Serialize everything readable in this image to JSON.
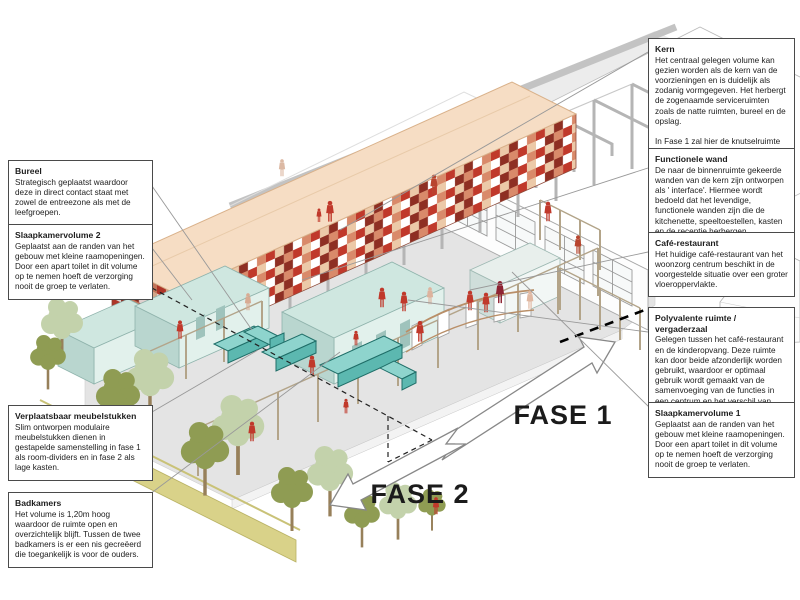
{
  "figure_labels": {
    "fase1": "FASE 1",
    "fase2": "FASE 2"
  },
  "annotations": {
    "right": [
      {
        "title": "Kern",
        "body": "Het centraal gelegen volume kan gezien worden als de kern van de voorzieningen en is duidelijk als zodanig vormgegeven. Het herbergt de zogenaamde serviceruimten zoals de natte ruimten, bureel en de opslag.\n\nIn Fase 1 zal hier de knutselruimte in worden ondergebracht die in Fase 2 wordt omgevormd tot een kantoortje."
      },
      {
        "title": "Functionele wand",
        "body": "De naar de binnenruimte gekeerde wanden van de kern zijn ontworpen als ' interface'. Hiermee wordt bedoeld dat het levendige, functionele wanden zijn die de kitchenette, speeltoestellen, kasten en de receptie herbergen."
      },
      {
        "title": "Café-restaurant",
        "body": "Het huidige café-restaurant van het woonzorg centrum beschikt in de voorgestelde situatie over een groter vloeroppervlakte."
      },
      {
        "title": "Polyvalente ruimte / vergaderzaal",
        "body": "Gelegen tussen het café-restaurant en de kinderopvang. Deze ruimte kan door beide afzonderlijk worden gebruikt, waardoor er optimaal gebruik wordt gemaakt van de samenvoeging van de functies in een centrum en het verschil van ieders ritme."
      },
      {
        "title": "Slaapkamervolume 1",
        "body": "Geplaatst aan de randen van het gebouw met kleine raamopeningen. Door een apart toilet in dit volume op te nemen hoeft de verzorging nooit de groep te verlaten."
      }
    ],
    "left": [
      {
        "title": "Bureel",
        "body": "Strategisch geplaatst waardoor deze in direct contact staat met zowel de entreezone als met de leefgroepen."
      },
      {
        "title": "Slaapkamervolume 2",
        "body": "Geplaatst aan de randen van het gebouw met kleine raamopeningen. Door een apart toilet in dit volume op te nemen hoeft de verzorging nooit de groep te verlaten."
      },
      {
        "title": "Verplaatsbaar meubelstukken",
        "body": "Slim ontworpen modulaire meubelstukken dienen in gestapelde samenstelling in fase 1 als room-dividers en in fase 2 als lage kasten."
      },
      {
        "title": "Badkamers",
        "body": "Het volume is 1,20m hoog waardoor de ruimte open en overzichtelijk blijft. Tussen de twee badkamers is er een nis gecreëerd die toegankelijk is voor de ouders."
      }
    ]
  },
  "colors": {
    "kern_roof": "#f6ddc4",
    "mosaic_palette": [
      "#8e2f23",
      "#c0392b",
      "#d98a6a",
      "#ecc9a8",
      "#ffffff"
    ],
    "volume_blue": "#cfe7e0",
    "furniture_teal": "#8ed4cd",
    "figure_red": "#c0392b",
    "structure_gray": "#b5b5b5",
    "partition_tan": "#b3a489",
    "berm_yellow": "#d9d289",
    "tree_olive": "#8f9c53",
    "tree_pale": "#c3d2ab"
  }
}
